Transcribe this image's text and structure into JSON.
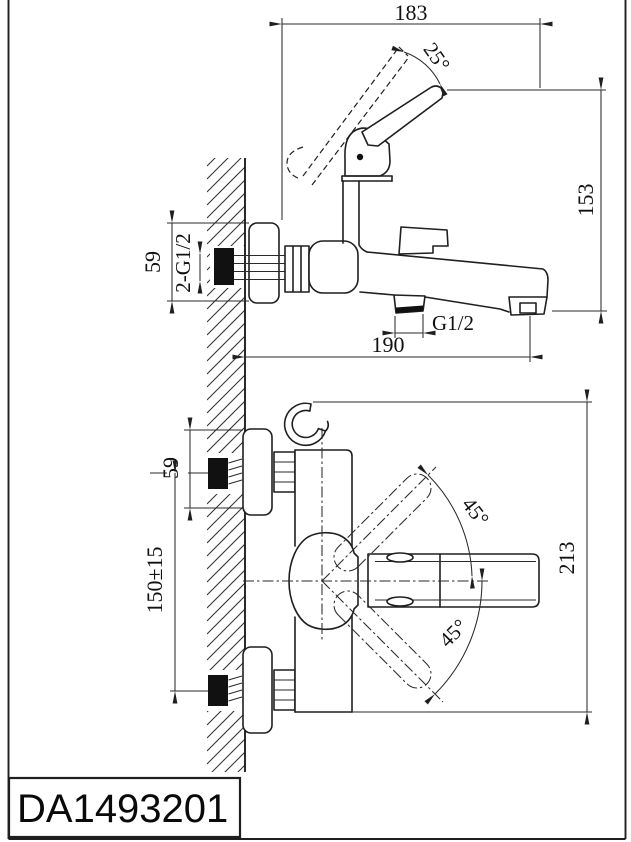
{
  "sheet": {
    "model_code": "DA1493201",
    "side_view": {
      "width_to_handle": "183",
      "handle_angle": "25°",
      "height": "153",
      "escutcheon_height": "59",
      "inlet_connections": "2-G1/2",
      "shower_outlet_thread": "G1/2",
      "depth": "190"
    },
    "front_view": {
      "escutcheon_height": "59",
      "inlet_centers_spacing": "150±15",
      "handle_swing_upper": "45°",
      "handle_swing_lower": "45°",
      "overall_height": "213"
    },
    "colors": {
      "ink": "#1f1f1f",
      "paper": "#ffffff"
    }
  }
}
